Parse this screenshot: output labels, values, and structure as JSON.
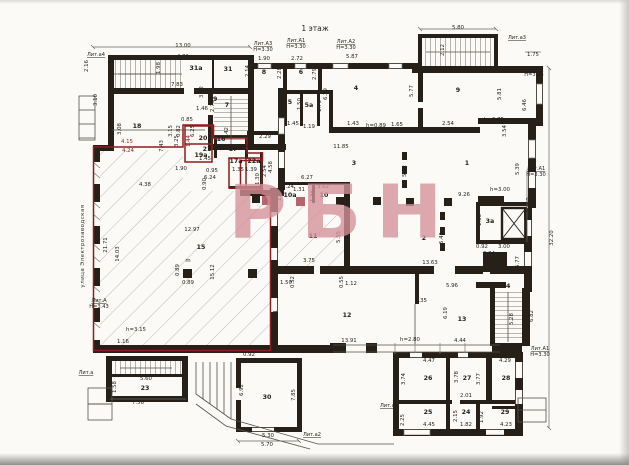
{
  "document": {
    "type": "floor-plan-scan",
    "floor_title": "1 этаж",
    "watermark": "РБН",
    "street_label": "улица Электрозаводская"
  },
  "colors": {
    "paper": "#fbfaf7",
    "wall": "#262019",
    "red_outline": "#8e1c1c",
    "watermark_pink": "#d4929a",
    "hatch": "#b0a49c"
  },
  "plan": {
    "labels": [
      {
        "t": "1 этаж",
        "x": 315,
        "y": 31,
        "c": "big"
      },
      {
        "t": "Лит.а4",
        "x": 96,
        "y": 56,
        "c": "lit",
        "u": 1
      },
      {
        "t": "13.00",
        "x": 183,
        "y": 47
      },
      {
        "t": "4.81",
        "x": 183,
        "y": 58
      },
      {
        "t": "2.16",
        "x": 88,
        "y": 66,
        "r": 1
      },
      {
        "t": "1.98",
        "x": 160,
        "y": 68,
        "r": 1
      },
      {
        "t": "31a",
        "x": 196,
        "y": 70,
        "c": "room"
      },
      {
        "t": "3.63",
        "x": 224,
        "y": 60
      },
      {
        "t": "31",
        "x": 228,
        "y": 71,
        "c": "room"
      },
      {
        "t": "2.14",
        "x": 249,
        "y": 71,
        "r": 1
      },
      {
        "t": "Лит.А3",
        "x": 263,
        "y": 45,
        "c": "lit",
        "u": 1
      },
      {
        "t": "Н=3.30",
        "x": 263,
        "y": 51,
        "c": "lit"
      },
      {
        "t": "1.90",
        "x": 264,
        "y": 60
      },
      {
        "t": "8",
        "x": 264,
        "y": 74,
        "c": "room"
      },
      {
        "t": "2.28",
        "x": 281,
        "y": 73,
        "r": 1
      },
      {
        "t": "Лит.А1",
        "x": 296,
        "y": 42,
        "c": "lit",
        "u": 1
      },
      {
        "t": "Н=3.30",
        "x": 296,
        "y": 48,
        "c": "lit"
      },
      {
        "t": "2.72",
        "x": 297,
        "y": 60
      },
      {
        "t": "6",
        "x": 301,
        "y": 74,
        "c": "room"
      },
      {
        "t": "2.79",
        "x": 316,
        "y": 74,
        "r": 1
      },
      {
        "t": "Лит.А2",
        "x": 346,
        "y": 43,
        "c": "lit",
        "u": 1
      },
      {
        "t": "Н=3.30",
        "x": 346,
        "y": 49,
        "c": "lit"
      },
      {
        "t": "5.87",
        "x": 352,
        "y": 58
      },
      {
        "t": "4",
        "x": 356,
        "y": 90,
        "c": "room"
      },
      {
        "t": "6.29",
        "x": 327,
        "y": 94,
        "r": 1
      },
      {
        "t": "5.80",
        "x": 458,
        "y": 29
      },
      {
        "t": "2.12",
        "x": 444,
        "y": 50,
        "r": 1
      },
      {
        "t": "Лит.а3",
        "x": 517,
        "y": 39,
        "c": "lit",
        "u": 1
      },
      {
        "t": "11.29",
        "x": 457,
        "y": 71
      },
      {
        "t": "1.75",
        "x": 533,
        "y": 56
      },
      {
        "t": "Лит.А4",
        "x": 534,
        "y": 70,
        "c": "lit",
        "u": 1
      },
      {
        "t": "Н=3.35",
        "x": 534,
        "y": 76,
        "c": "lit"
      },
      {
        "t": "9",
        "x": 458,
        "y": 92,
        "c": "room"
      },
      {
        "t": "5.77",
        "x": 413,
        "y": 91,
        "r": 1
      },
      {
        "t": "5.81",
        "x": 501,
        "y": 94,
        "r": 1
      },
      {
        "t": "6.46",
        "x": 526,
        "y": 105,
        "r": 1
      },
      {
        "t": "7.83",
        "x": 177,
        "y": 86
      },
      {
        "t": "3.10",
        "x": 97,
        "y": 100,
        "r": 1
      },
      {
        "t": "19",
        "x": 213,
        "y": 101,
        "c": "room"
      },
      {
        "t": "3.02",
        "x": 203,
        "y": 92,
        "r": 1
      },
      {
        "t": "1.46",
        "x": 202,
        "y": 110
      },
      {
        "t": "5.50",
        "x": 240,
        "y": 92
      },
      {
        "t": "7",
        "x": 227,
        "y": 107,
        "c": "room"
      },
      {
        "t": "2.73",
        "x": 214,
        "y": 106,
        "r": 1
      },
      {
        "t": "5",
        "x": 290,
        "y": 104,
        "c": "room"
      },
      {
        "t": "1.50",
        "x": 301,
        "y": 104,
        "r": 1
      },
      {
        "t": "5a",
        "x": 309,
        "y": 107,
        "c": "room"
      },
      {
        "t": "1.70",
        "x": 321,
        "y": 106,
        "r": 1
      },
      {
        "t": "1.45",
        "x": 293,
        "y": 125
      },
      {
        "t": "1.19",
        "x": 309,
        "y": 128
      },
      {
        "t": "2.29",
        "x": 265,
        "y": 138
      },
      {
        "t": "18",
        "x": 137,
        "y": 128,
        "c": "room"
      },
      {
        "t": "3.15",
        "x": 172,
        "y": 131,
        "r": 1
      },
      {
        "t": "0.85",
        "x": 187,
        "y": 121
      },
      {
        "t": "0.82",
        "x": 180,
        "y": 131,
        "r": 1
      },
      {
        "t": "6.25",
        "x": 194,
        "y": 131,
        "r": 1
      },
      {
        "t": "0.96",
        "x": 112,
        "y": 127,
        "r": 1
      },
      {
        "t": "3.08",
        "x": 121,
        "y": 129,
        "r": 1
      },
      {
        "t": "h=2.85",
        "x": 494,
        "y": 121
      },
      {
        "t": "1.04",
        "x": 515,
        "y": 124
      },
      {
        "t": "3.54",
        "x": 506,
        "y": 131,
        "r": 1
      },
      {
        "t": "h=0.89",
        "x": 376,
        "y": 127
      },
      {
        "t": "1.65",
        "x": 397,
        "y": 126
      },
      {
        "t": "1.43",
        "x": 353,
        "y": 125
      },
      {
        "t": "2.54",
        "x": 448,
        "y": 125
      },
      {
        "t": "4.15",
        "x": 127,
        "y": 143,
        "c": "red"
      },
      {
        "t": "4.24",
        "x": 128,
        "y": 152,
        "c": "red"
      },
      {
        "t": "7.43",
        "x": 163,
        "y": 146,
        "r": 1
      },
      {
        "t": "3.25",
        "x": 178,
        "y": 141,
        "r": 1
      },
      {
        "t": "1.44",
        "x": 190,
        "y": 141,
        "r": 1,
        "c": "red"
      },
      {
        "t": "20",
        "x": 203,
        "y": 140,
        "c": "room"
      },
      {
        "t": "21",
        "x": 207,
        "y": 151,
        "c": "room"
      },
      {
        "t": "1.45",
        "x": 205,
        "y": 160
      },
      {
        "t": "16",
        "x": 221,
        "y": 141,
        "c": "room"
      },
      {
        "t": "1.42",
        "x": 228,
        "y": 133,
        "r": 1
      },
      {
        "t": "17",
        "x": 233,
        "y": 151,
        "c": "room"
      },
      {
        "t": "1.42",
        "x": 247,
        "y": 148
      },
      {
        "t": "17a",
        "x": 236,
        "y": 163,
        "c": "room"
      },
      {
        "t": "22a",
        "x": 254,
        "y": 163,
        "c": "room"
      },
      {
        "t": "1.35",
        "x": 238,
        "y": 171
      },
      {
        "t": "1.39",
        "x": 251,
        "y": 171
      },
      {
        "t": "1.30",
        "x": 259,
        "y": 179,
        "r": 1
      },
      {
        "t": "2.54",
        "x": 266,
        "y": 171,
        "r": 1
      },
      {
        "t": "19a",
        "x": 201,
        "y": 157,
        "c": "room"
      },
      {
        "t": "1.90",
        "x": 181,
        "y": 170
      },
      {
        "t": "0.95",
        "x": 212,
        "y": 172
      },
      {
        "t": "6.24",
        "x": 210,
        "y": 179
      },
      {
        "t": "0.90",
        "x": 206,
        "y": 184,
        "r": 1
      },
      {
        "t": "4.38",
        "x": 145,
        "y": 186
      },
      {
        "t": "22",
        "x": 271,
        "y": 150,
        "c": "room"
      },
      {
        "t": "4.58",
        "x": 272,
        "y": 167,
        "r": 1
      },
      {
        "t": "11.85",
        "x": 341,
        "y": 148
      },
      {
        "t": "3",
        "x": 354,
        "y": 165,
        "c": "room"
      },
      {
        "t": "5.42",
        "x": 406,
        "y": 171,
        "r": 1
      },
      {
        "t": "1",
        "x": 467,
        "y": 165,
        "c": "room"
      },
      {
        "t": "9.26",
        "x": 464,
        "y": 196
      },
      {
        "t": "h=3.00",
        "x": 500,
        "y": 191
      },
      {
        "t": "5.39",
        "x": 519,
        "y": 169,
        "r": 1
      },
      {
        "t": "Лит.А1",
        "x": 536,
        "y": 170,
        "c": "lit",
        "u": 1
      },
      {
        "t": "Н=3.30",
        "x": 536,
        "y": 176,
        "c": "lit"
      },
      {
        "t": "12.50",
        "x": 530,
        "y": 205,
        "r": 1
      },
      {
        "t": "32.20",
        "x": 553,
        "y": 238,
        "r": 1
      },
      {
        "t": "3.36",
        "x": 492,
        "y": 206
      },
      {
        "t": "1.66",
        "x": 481,
        "y": 220,
        "r": 1
      },
      {
        "t": "3a",
        "x": 490,
        "y": 223,
        "c": "room"
      },
      {
        "t": "3.00",
        "x": 504,
        "y": 248
      },
      {
        "t": "0.92",
        "x": 482,
        "y": 248
      },
      {
        "t": "0.34",
        "x": 489,
        "y": 255
      },
      {
        "t": "5.77",
        "x": 519,
        "y": 262,
        "r": 1
      },
      {
        "t": "6.27",
        "x": 307,
        "y": 179
      },
      {
        "t": "2.24",
        "x": 288,
        "y": 188
      },
      {
        "t": "1.31",
        "x": 299,
        "y": 191
      },
      {
        "t": "3.62",
        "x": 323,
        "y": 188
      },
      {
        "t": "10a",
        "x": 290,
        "y": 197,
        "c": "room"
      },
      {
        "t": "10",
        "x": 324,
        "y": 197,
        "c": "room"
      },
      {
        "t": "1.36",
        "x": 314,
        "y": 196,
        "r": 1
      },
      {
        "t": "1.48",
        "x": 281,
        "y": 195,
        "r": 1
      },
      {
        "t": "11",
        "x": 313,
        "y": 238,
        "c": "room"
      },
      {
        "t": "5.55",
        "x": 340,
        "y": 237,
        "r": 1
      },
      {
        "t": "7.46",
        "x": 348,
        "y": 229,
        "r": 1
      },
      {
        "t": "2",
        "x": 424,
        "y": 240,
        "c": "room"
      },
      {
        "t": "5.41",
        "x": 443,
        "y": 238,
        "r": 1
      },
      {
        "t": "улица Электрозаводская",
        "x": 84,
        "y": 246,
        "r": 1,
        "c": "street"
      },
      {
        "t": "21.71",
        "x": 107,
        "y": 245,
        "r": 1
      },
      {
        "t": "14.03",
        "x": 119,
        "y": 254,
        "r": 1
      },
      {
        "t": "15",
        "x": 201,
        "y": 249,
        "c": "room"
      },
      {
        "t": "12.97",
        "x": 192,
        "y": 231
      },
      {
        "t": "15.12",
        "x": 214,
        "y": 272,
        "r": 1
      },
      {
        "t": "Лит.А",
        "x": 99,
        "y": 302,
        "c": "lit",
        "u": 1
      },
      {
        "t": "Н=3.43",
        "x": 99,
        "y": 308,
        "c": "lit"
      },
      {
        "t": "h=3.15",
        "x": 136,
        "y": 331
      },
      {
        "t": "1.16",
        "x": 123,
        "y": 343
      },
      {
        "t": "m",
        "x": 188,
        "y": 262
      },
      {
        "t": "0.89",
        "x": 179,
        "y": 270,
        "r": 1
      },
      {
        "t": "0.89",
        "x": 188,
        "y": 284
      },
      {
        "t": "5.71",
        "x": 277,
        "y": 316,
        "r": 1
      },
      {
        "t": "3.75",
        "x": 309,
        "y": 262
      },
      {
        "t": "1.50",
        "x": 286,
        "y": 284
      },
      {
        "t": "0.52",
        "x": 294,
        "y": 282,
        "r": 1
      },
      {
        "t": "0.55",
        "x": 343,
        "y": 282,
        "r": 1
      },
      {
        "t": "1.12",
        "x": 351,
        "y": 285
      },
      {
        "t": "13.63",
        "x": 430,
        "y": 264
      },
      {
        "t": "5.96",
        "x": 452,
        "y": 287
      },
      {
        "t": "1.35",
        "x": 421,
        "y": 302
      },
      {
        "t": "6.19",
        "x": 447,
        "y": 313,
        "r": 1
      },
      {
        "t": "12",
        "x": 347,
        "y": 317,
        "c": "room"
      },
      {
        "t": "13",
        "x": 462,
        "y": 321,
        "c": "room"
      },
      {
        "t": "13.91",
        "x": 349,
        "y": 342
      },
      {
        "t": "h=2.80",
        "x": 410,
        "y": 341
      },
      {
        "t": "4.44",
        "x": 460,
        "y": 342
      },
      {
        "t": "2.96",
        "x": 507,
        "y": 349
      },
      {
        "t": "14",
        "x": 506,
        "y": 288,
        "c": "room"
      },
      {
        "t": "5.28",
        "x": 513,
        "y": 319,
        "r": 1
      },
      {
        "t": "6.82",
        "x": 533,
        "y": 316,
        "r": 1
      },
      {
        "t": "Лит.А1",
        "x": 540,
        "y": 350,
        "c": "lit",
        "u": 1
      },
      {
        "t": "Н=3.30",
        "x": 540,
        "y": 356,
        "c": "lit"
      },
      {
        "t": "4.47",
        "x": 429,
        "y": 362
      },
      {
        "t": "4.29",
        "x": 505,
        "y": 362
      },
      {
        "t": "26",
        "x": 428,
        "y": 380,
        "c": "room"
      },
      {
        "t": "3.74",
        "x": 405,
        "y": 379,
        "r": 1
      },
      {
        "t": "6.92",
        "x": 398,
        "y": 386,
        "r": 1
      },
      {
        "t": "27",
        "x": 467,
        "y": 380,
        "c": "room"
      },
      {
        "t": "3.78",
        "x": 458,
        "y": 377,
        "r": 1
      },
      {
        "t": "28",
        "x": 506,
        "y": 380,
        "c": "room"
      },
      {
        "t": "3.77",
        "x": 480,
        "y": 379,
        "r": 1
      },
      {
        "t": "2.01",
        "x": 466,
        "y": 397
      },
      {
        "t": "Лит.а1",
        "x": 389,
        "y": 407,
        "c": "lit",
        "u": 1
      },
      {
        "t": "25",
        "x": 428,
        "y": 414,
        "c": "room"
      },
      {
        "t": "2.25",
        "x": 404,
        "y": 420,
        "r": 1
      },
      {
        "t": "24",
        "x": 466,
        "y": 414,
        "c": "room"
      },
      {
        "t": "2.15",
        "x": 457,
        "y": 416,
        "r": 1
      },
      {
        "t": "1.92",
        "x": 483,
        "y": 417,
        "r": 1
      },
      {
        "t": "29",
        "x": 505,
        "y": 414,
        "c": "room"
      },
      {
        "t": "4.45",
        "x": 429,
        "y": 426
      },
      {
        "t": "1.82",
        "x": 466,
        "y": 426
      },
      {
        "t": "4.23",
        "x": 506,
        "y": 426
      },
      {
        "t": "Лит.а",
        "x": 86,
        "y": 374,
        "c": "lit",
        "u": 1
      },
      {
        "t": "5.60",
        "x": 146,
        "y": 380
      },
      {
        "t": "23",
        "x": 145,
        "y": 390,
        "c": "room"
      },
      {
        "t": "1.58",
        "x": 116,
        "y": 387,
        "r": 1
      },
      {
        "t": "7.56",
        "x": 138,
        "y": 404
      },
      {
        "t": "3.16",
        "x": 186,
        "y": 369,
        "r": 1
      },
      {
        "t": "0.92",
        "x": 249,
        "y": 356
      },
      {
        "t": "6.92",
        "x": 243,
        "y": 390,
        "r": 1
      },
      {
        "t": "30",
        "x": 267,
        "y": 399,
        "c": "room"
      },
      {
        "t": "7.85",
        "x": 295,
        "y": 395,
        "r": 1
      },
      {
        "t": "5.30",
        "x": 268,
        "y": 437
      },
      {
        "t": "5.70",
        "x": 267,
        "y": 446
      },
      {
        "t": "Лит.а2",
        "x": 312,
        "y": 436,
        "c": "lit",
        "u": 1
      }
    ]
  }
}
